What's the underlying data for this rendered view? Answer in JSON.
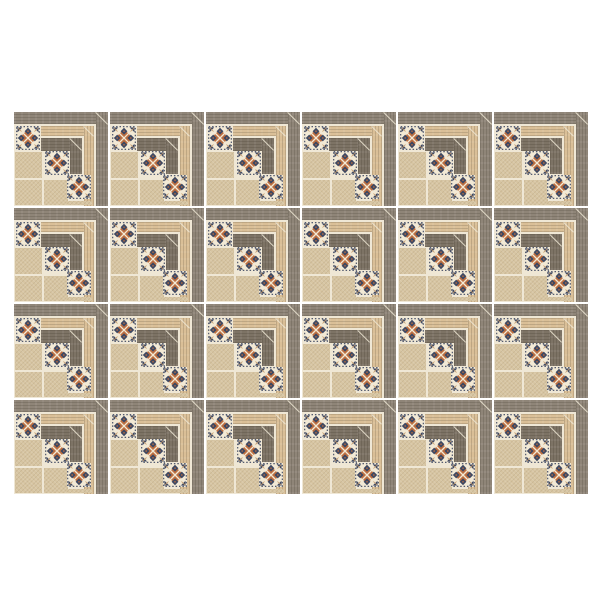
{
  "scene": {
    "background_color": "#ffffff"
  },
  "tile_grid": {
    "rows": 4,
    "columns": 6,
    "tile_count": 24,
    "tile_size_px": 94,
    "gap_px": 2,
    "left_px": 14,
    "top_px": 112
  },
  "tile": {
    "colors": {
      "page_bg": "#ffffff",
      "grout_cream": "#efe7d5",
      "field_beige": "#d7c5a2",
      "wood_grey": "#8f8578",
      "wood_tan": "#dabf97",
      "wood_dark": "#7d7365",
      "motif_navy": "#3d4761",
      "motif_terracotta": "#bd6f41",
      "motif_cream": "#f2e9d5",
      "motif_line_tan": "#c89c6a"
    }
  }
}
